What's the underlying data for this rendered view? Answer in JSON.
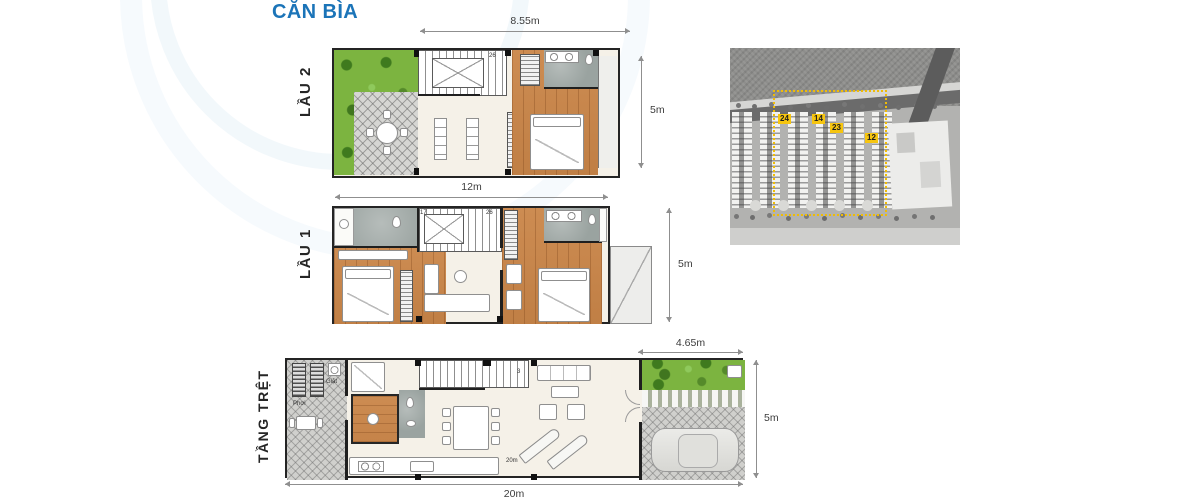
{
  "title": "CĂN BÌA",
  "floors": {
    "lau2": {
      "label": "LẦU 2",
      "dim_top": "8.55m",
      "dim_right": "5m",
      "stair_top_step": "26"
    },
    "lau1": {
      "label": "LẦU 1",
      "dim_top": "12m",
      "dim_right": "5m",
      "stair_first_step": "17",
      "stair_top_step": "26"
    },
    "tret": {
      "label": "TẦNG TRỆT",
      "dim_top": "4.65m",
      "dim_right": "5m",
      "dim_bottom": "20m",
      "laundry_label": "Giặt",
      "drying_label": "Phơi",
      "stair_step": "3",
      "garage_note": "20m"
    }
  },
  "site_map": {
    "blocks": {
      "b24": "24",
      "b14": "14",
      "b23": "23",
      "b12": "12"
    }
  },
  "colors": {
    "title_blue": "#1b74b8",
    "highlight_yellow": "#f6c50f",
    "garden_green": "#7cb440",
    "wood_floor": "#c8884f",
    "wall_dark": "#1f1f1f"
  }
}
